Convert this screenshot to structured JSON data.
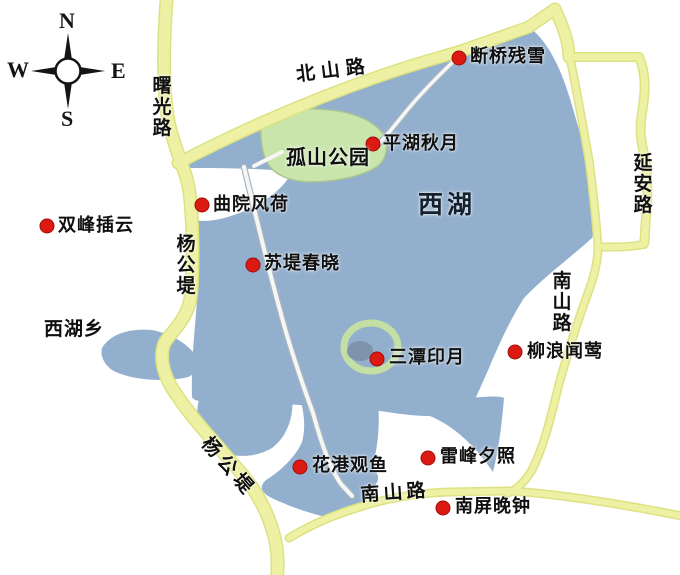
{
  "colors": {
    "lake": "#92afcd",
    "lake_dark_islet": "#7e93ac",
    "road_fill": "#eef0a3",
    "road_edge": "#dce282",
    "park_green": "#c9e5ac",
    "causeway_white": "#f6f7f4",
    "marker_red": "#dc1a12",
    "label_text": "#101010"
  },
  "compass": {
    "n": "N",
    "e": "E",
    "s": "S",
    "w": "W"
  },
  "areas": {
    "lake_label": "西湖",
    "park_label": "孤山公园",
    "township_label": "西湖乡"
  },
  "roads": {
    "shuguang": "曙光路",
    "beishan": "北山路",
    "yanan": "延安路",
    "nanshan_east": "南山路",
    "nanshan_south": "南山路",
    "yanggong_upper": "杨公堤",
    "yanggong_lower": "杨公堤"
  },
  "spots": [
    {
      "label": "断桥残雪"
    },
    {
      "label": "平湖秋月"
    },
    {
      "label": "曲院风荷"
    },
    {
      "label": "双峰插云"
    },
    {
      "label": "苏堤春晓"
    },
    {
      "label": "三潭印月"
    },
    {
      "label": "柳浪闻莺"
    },
    {
      "label": "花港观鱼"
    },
    {
      "label": "雷峰夕照"
    },
    {
      "label": "南屏晚钟"
    }
  ]
}
